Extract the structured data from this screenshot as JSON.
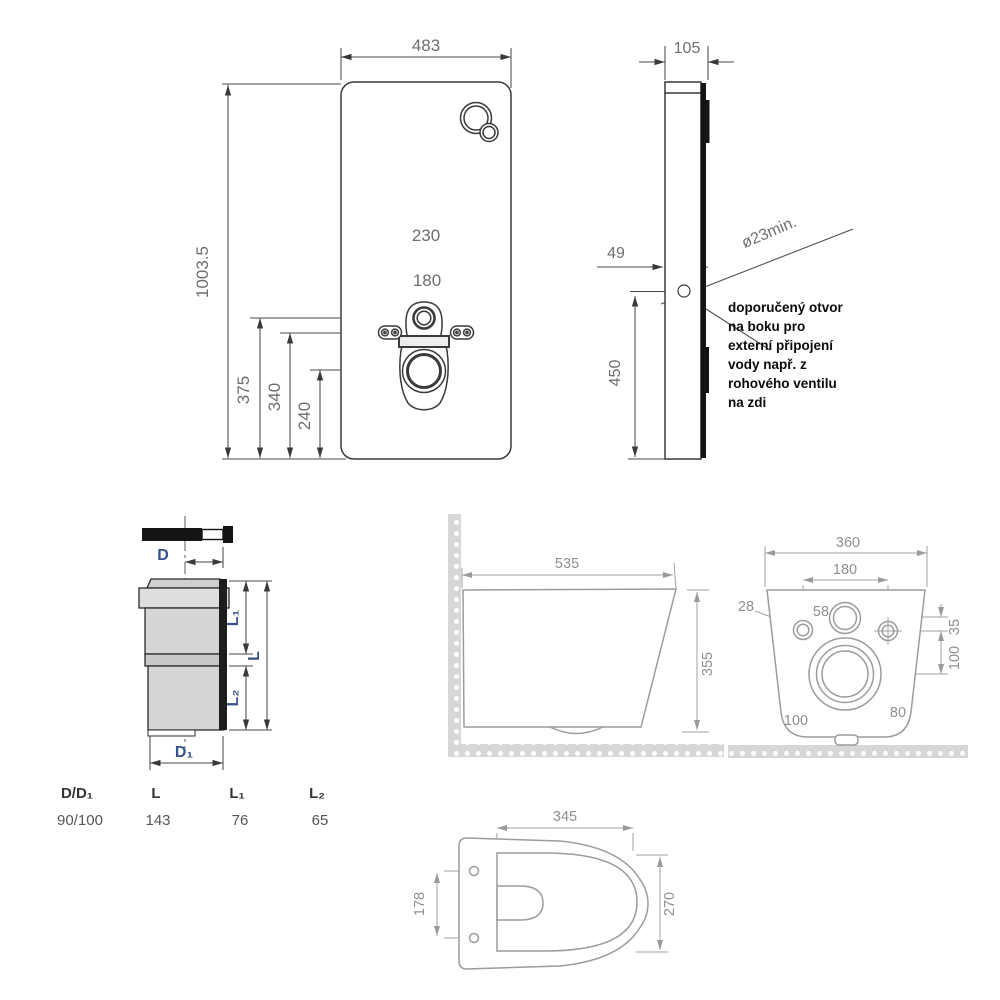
{
  "front_view": {
    "width": "483",
    "height": "1003.5",
    "bolt_spacing_outer": "230",
    "bolt_spacing_inner": "180",
    "inlet_height": "375",
    "bolt_height": "340",
    "drain_height": "240"
  },
  "side_view": {
    "depth": "105",
    "hole_offset": "49",
    "hole_height": "450",
    "hole_diameter": "ø23min.",
    "note_lines": [
      "doporučený otvor",
      "na boku pro",
      "externí připojení",
      "vody např. z",
      "rohového ventilu",
      "na zdi"
    ]
  },
  "pipe": {
    "dim_d": "D",
    "dim_d1": "D₁",
    "dim_l": "L",
    "dim_l1": "L₁",
    "dim_l2": "L₂",
    "table": {
      "headers": [
        "D/D₁",
        "L",
        "L₁",
        "L₂"
      ],
      "row": [
        "90/100",
        "143",
        "76",
        "65"
      ]
    }
  },
  "wc_side": {
    "length": "535",
    "height": "355"
  },
  "wc_back": {
    "width": "360",
    "bolt_spacing": "180",
    "bolt_hole_dia": "28",
    "inlet_dia": "58",
    "inlet_to_bolts": "35",
    "bolts_to_drain": "100",
    "drain_inner_dia": "80",
    "drain_outer_dia": "100"
  },
  "wc_top": {
    "bowl_length": "345",
    "seat_bolt_spacing": "178",
    "bowl_width": "270"
  },
  "colors": {
    "line_dark": "#3a3a3a",
    "line_light": "#9c9c9c",
    "pipe_fill": "#d6d6d6",
    "pipe_label": "#35518c",
    "hatch_strip": "#d7d7d7"
  }
}
